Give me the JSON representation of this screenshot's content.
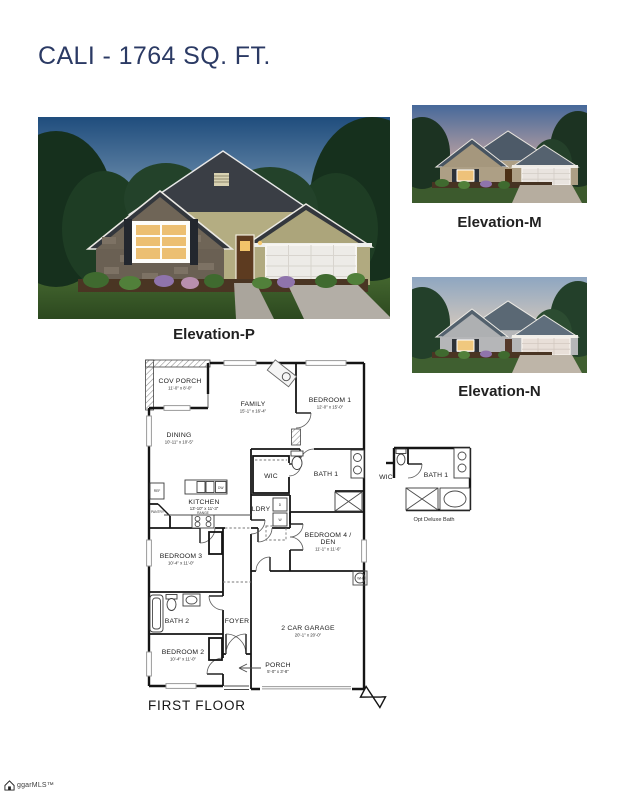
{
  "page": {
    "title": "CALI - 1764 SQ. FT."
  },
  "elevations": {
    "p": {
      "label": "Elevation-P"
    },
    "m": {
      "label": "Elevation-M"
    },
    "n": {
      "label": "Elevation-N"
    }
  },
  "floor_plan": {
    "caption": "FIRST FLOOR",
    "rooms": {
      "cov_porch": {
        "name": "COV PORCH",
        "dims": "11'-0\" x 8'-0\""
      },
      "family": {
        "name": "FAMILY",
        "dims": "15'-1\" x 16'-4\""
      },
      "bedroom1": {
        "name": "BEDROOM 1",
        "dims": "12'-0\" x 15'-0\""
      },
      "dining": {
        "name": "DINING",
        "dims": "10'-11\" x 10'-5\""
      },
      "wic": {
        "name": "WIC"
      },
      "bath1": {
        "name": "BATH 1"
      },
      "kitchen": {
        "name": "KITCHEN",
        "dims": "13'-10\" x 11'-3\""
      },
      "ldry": {
        "name": "LDRY"
      },
      "bedroom4": {
        "name": "BEDROOM 4 /",
        "name2": "DEN",
        "dims": "11'-1\" x 11'-6\""
      },
      "bedroom3": {
        "name": "BEDROOM 3",
        "dims": "10'-4\" x 11'-0\""
      },
      "bath2": {
        "name": "BATH 2"
      },
      "foyer": {
        "name": "FOYER"
      },
      "bedroom2": {
        "name": "BEDROOM 2",
        "dims": "10'-4\" x 11'-0\""
      },
      "garage": {
        "name": "2 CAR GARAGE",
        "dims": "20'-1\" x 20'-0\""
      },
      "porch": {
        "name": "PORCH",
        "dims": "5'-0\" x 3'-8\""
      }
    },
    "appliances": {
      "pantry": "PANTRY",
      "range": "RANGE",
      "ref": "REF",
      "dw": "DW",
      "dryer": "D",
      "washer": "W",
      "water_heater": "WH"
    },
    "optional_bath": {
      "wic": "WIC",
      "bath": "BATH 1",
      "caption": "Opt Deluxe Bath"
    }
  },
  "footer": {
    "mls_logo_text": "ggarMLS™"
  },
  "colors": {
    "title": "#2b3a64",
    "caption_text": "#212121",
    "plan_line": "#151515"
  }
}
